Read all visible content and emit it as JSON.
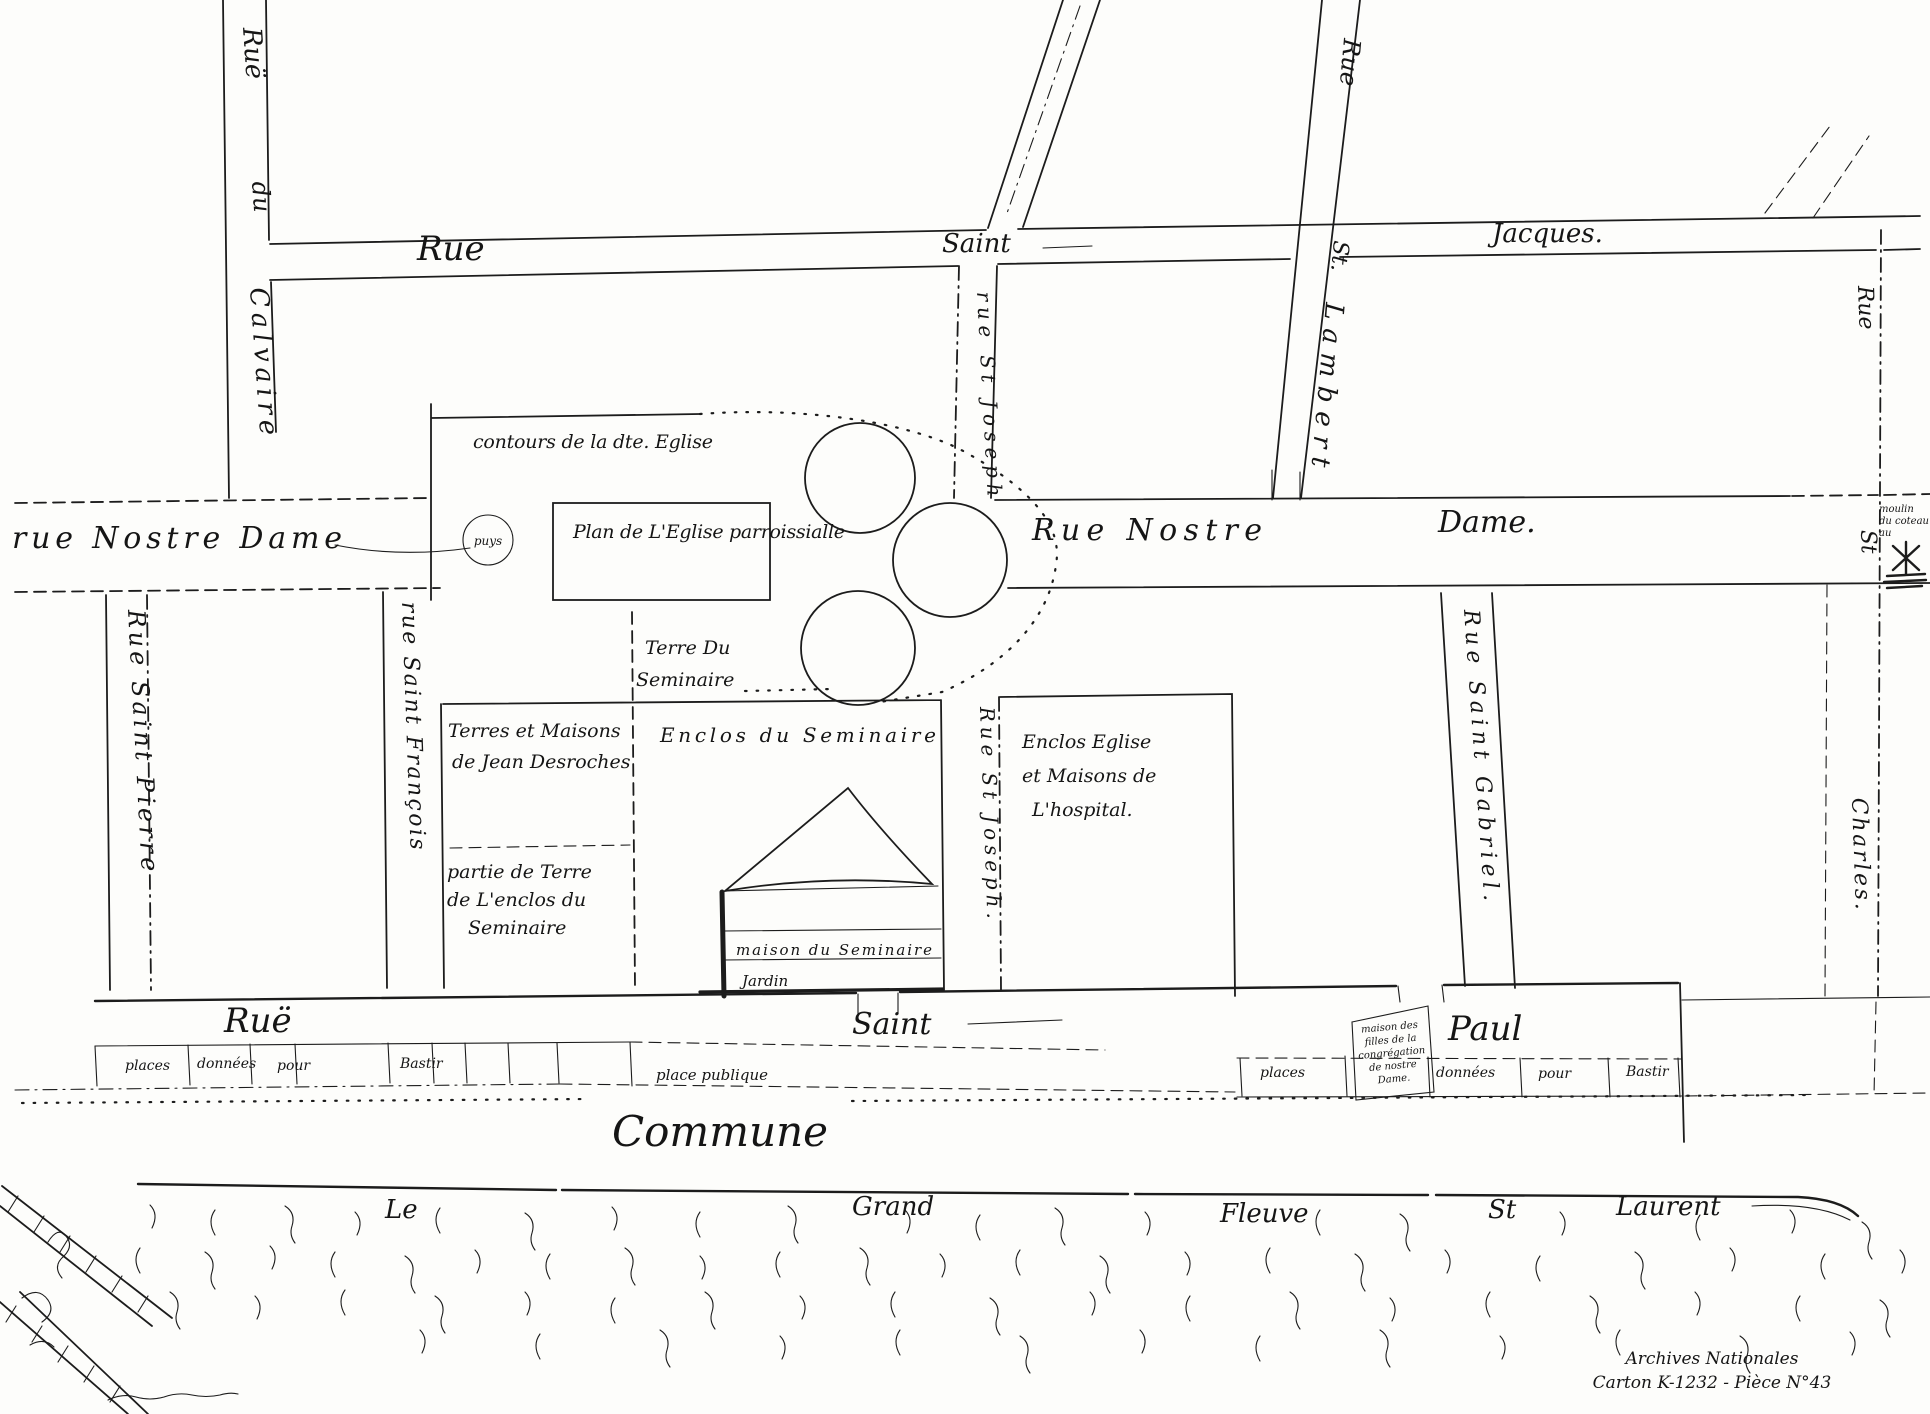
{
  "map": {
    "streets": {
      "jacques": {
        "rue": "Rue",
        "saint": "Saint",
        "name": "Jacques."
      },
      "notre_dame": {
        "left": "rue Nostre Dame",
        "well": "puys",
        "rue_nostre": "Rue Nostre",
        "dame": "Dame."
      },
      "calvaire": {
        "rue": "Ruë",
        "du": "du",
        "name": "Calvaire"
      },
      "st_joseph_upper": "rue St Joseph",
      "st_lambert": {
        "rue": "Rue",
        "st": "St.",
        "name": "Lambert"
      },
      "st_charles": {
        "rue": "Rue",
        "st": "St",
        "name": "Charles."
      },
      "st_pierre": "Rue Saint Pierre",
      "st_francois": "rue Saint François",
      "st_joseph_lower": "Rue St Joseph.",
      "st_gabriel": "Rue Saint Gabriel.",
      "paul": {
        "rue": "Ruë",
        "saint": "Saint",
        "name": "Paul"
      }
    },
    "church": {
      "contours": "contours de la dte. Eglise",
      "plan": "Plan de L'Eglise parroissialle"
    },
    "blocks": {
      "terre_seminaire": [
        "Terre Du",
        "Seminaire"
      ],
      "desroches": [
        "Terres et Maisons",
        "de Jean Desroches"
      ],
      "enclos_seminaire": "Enclos du Seminaire",
      "partie": [
        "partie de Terre",
        "de L'enclos du",
        "Seminaire"
      ],
      "maison": "maison du Seminaire",
      "jardin": "Jardin",
      "hospital": [
        "Enclos Eglise",
        "et Maisons de",
        "L'hospital."
      ]
    },
    "plots": {
      "left": [
        "places",
        "données",
        "pour",
        "Bastir"
      ],
      "place_publique": "place publique",
      "right": [
        "places",
        "données",
        "pour",
        "Bastir"
      ],
      "congregation": [
        "maison des",
        "filles de la",
        "congrégation",
        "de nostre",
        "Dame."
      ]
    },
    "commune": "Commune",
    "river": [
      "Le",
      "Grand",
      "Fleuve",
      "St",
      "Laurent"
    ],
    "moulin": [
      "moulin",
      "du coteau",
      "au"
    ],
    "archives": [
      "Archives Nationales",
      "Carton K-1232 - Pièce N°43"
    ]
  }
}
